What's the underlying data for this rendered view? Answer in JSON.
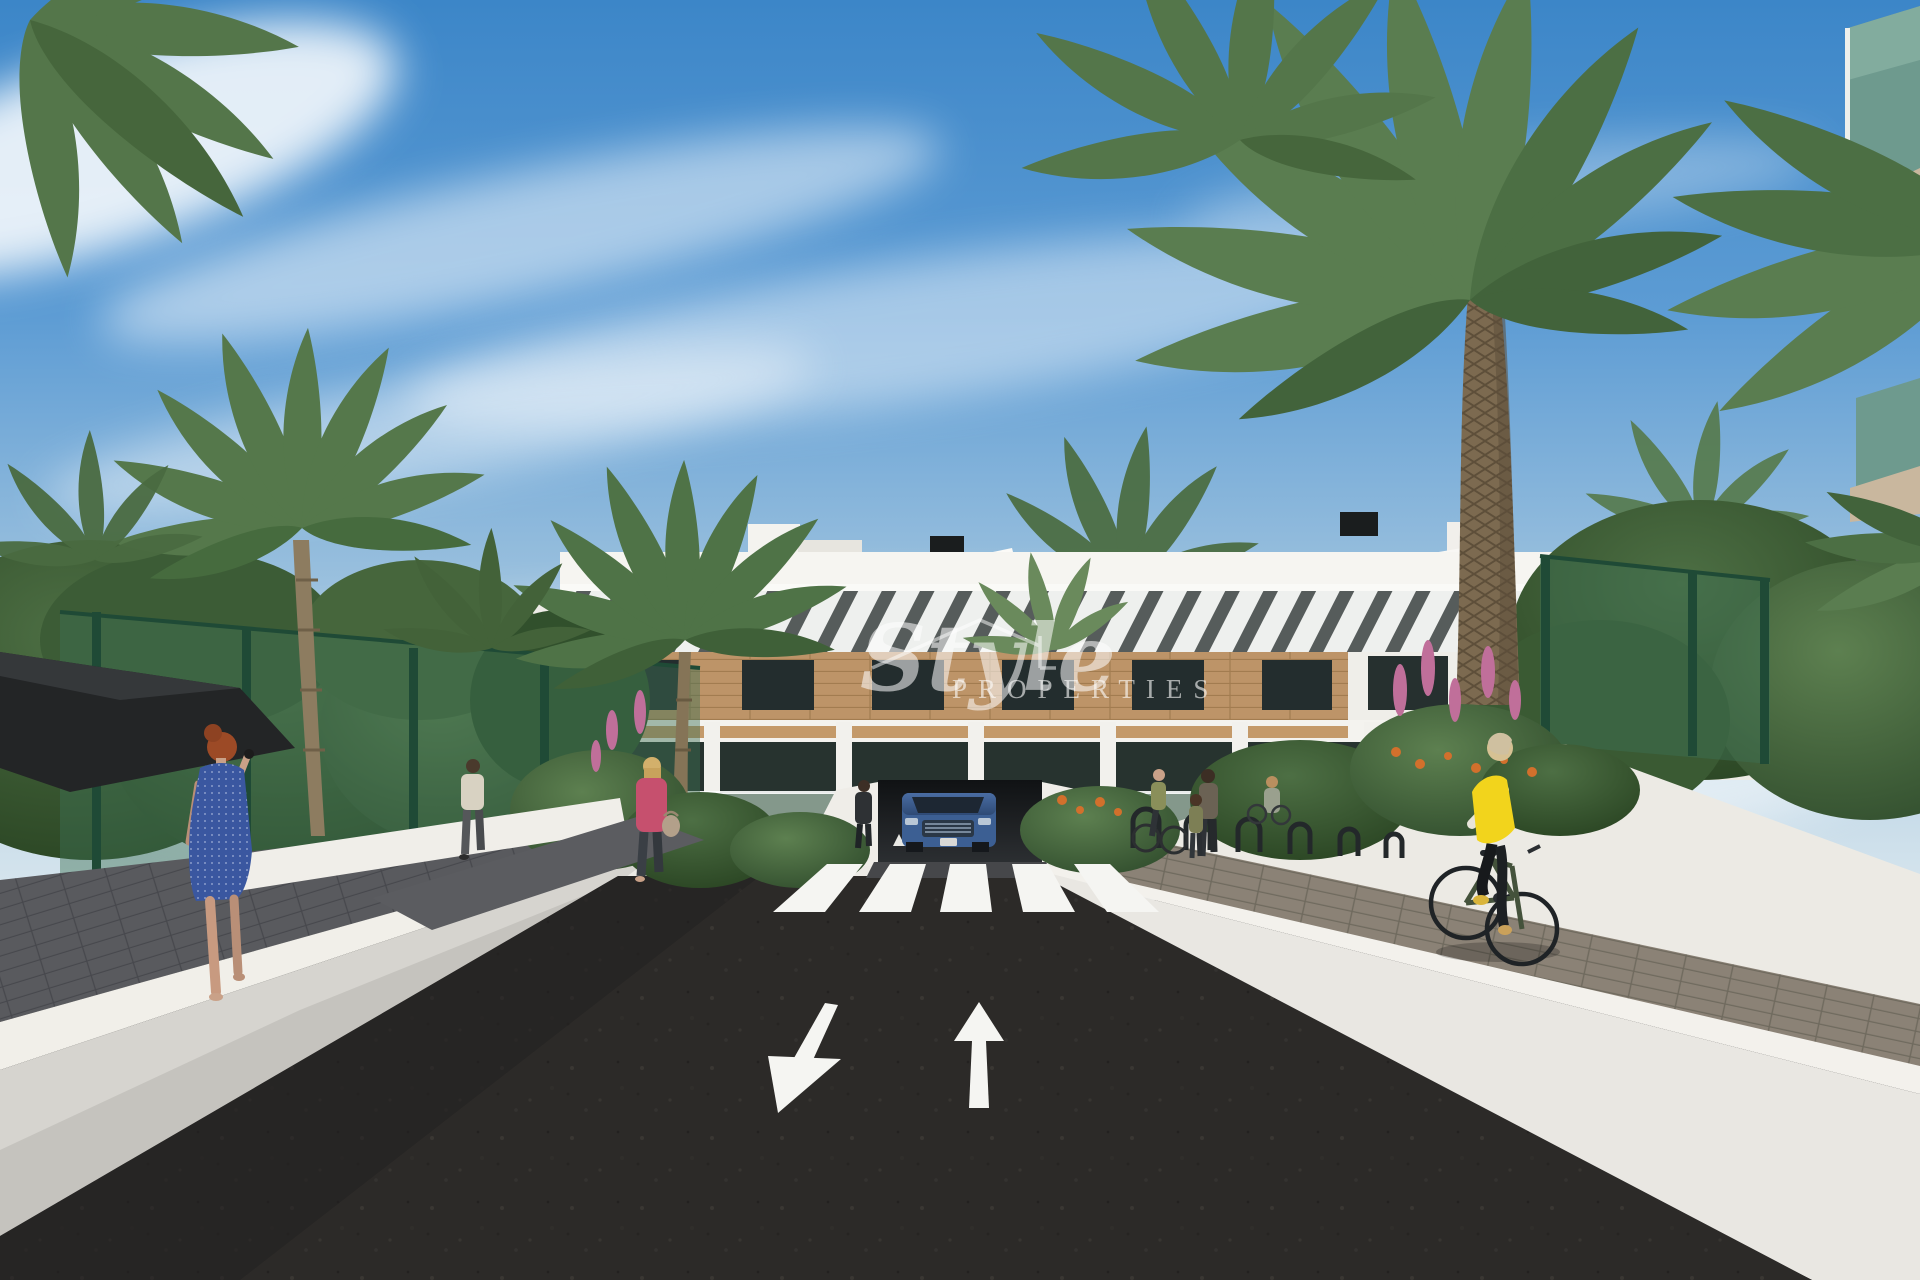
{
  "watermark": {
    "brand_script": "Style",
    "brand_caps": "PROPERTIES"
  },
  "colors": {
    "sky_top": "#3c86c8",
    "sky_horizon": "#d8e6ee",
    "facade_white": "#f2f1ed",
    "wood": "#bd9468",
    "asphalt": "#2c2a28",
    "road_marking": "#f5f5f2",
    "wall_white": "#e9e7e2",
    "paver_path": "#8b8276",
    "fence_green": "#3f7055",
    "foliage_dark": "#2e4a2b",
    "foliage_light": "#5d8050",
    "car_blue": "#3c5f93",
    "vest_yellow": "#f2d41c",
    "dress_blue": "#3a57a0",
    "jacket_pink": "#c6506e",
    "glass_dark": "#27332f",
    "balcony_glass": "#a9bfae"
  }
}
